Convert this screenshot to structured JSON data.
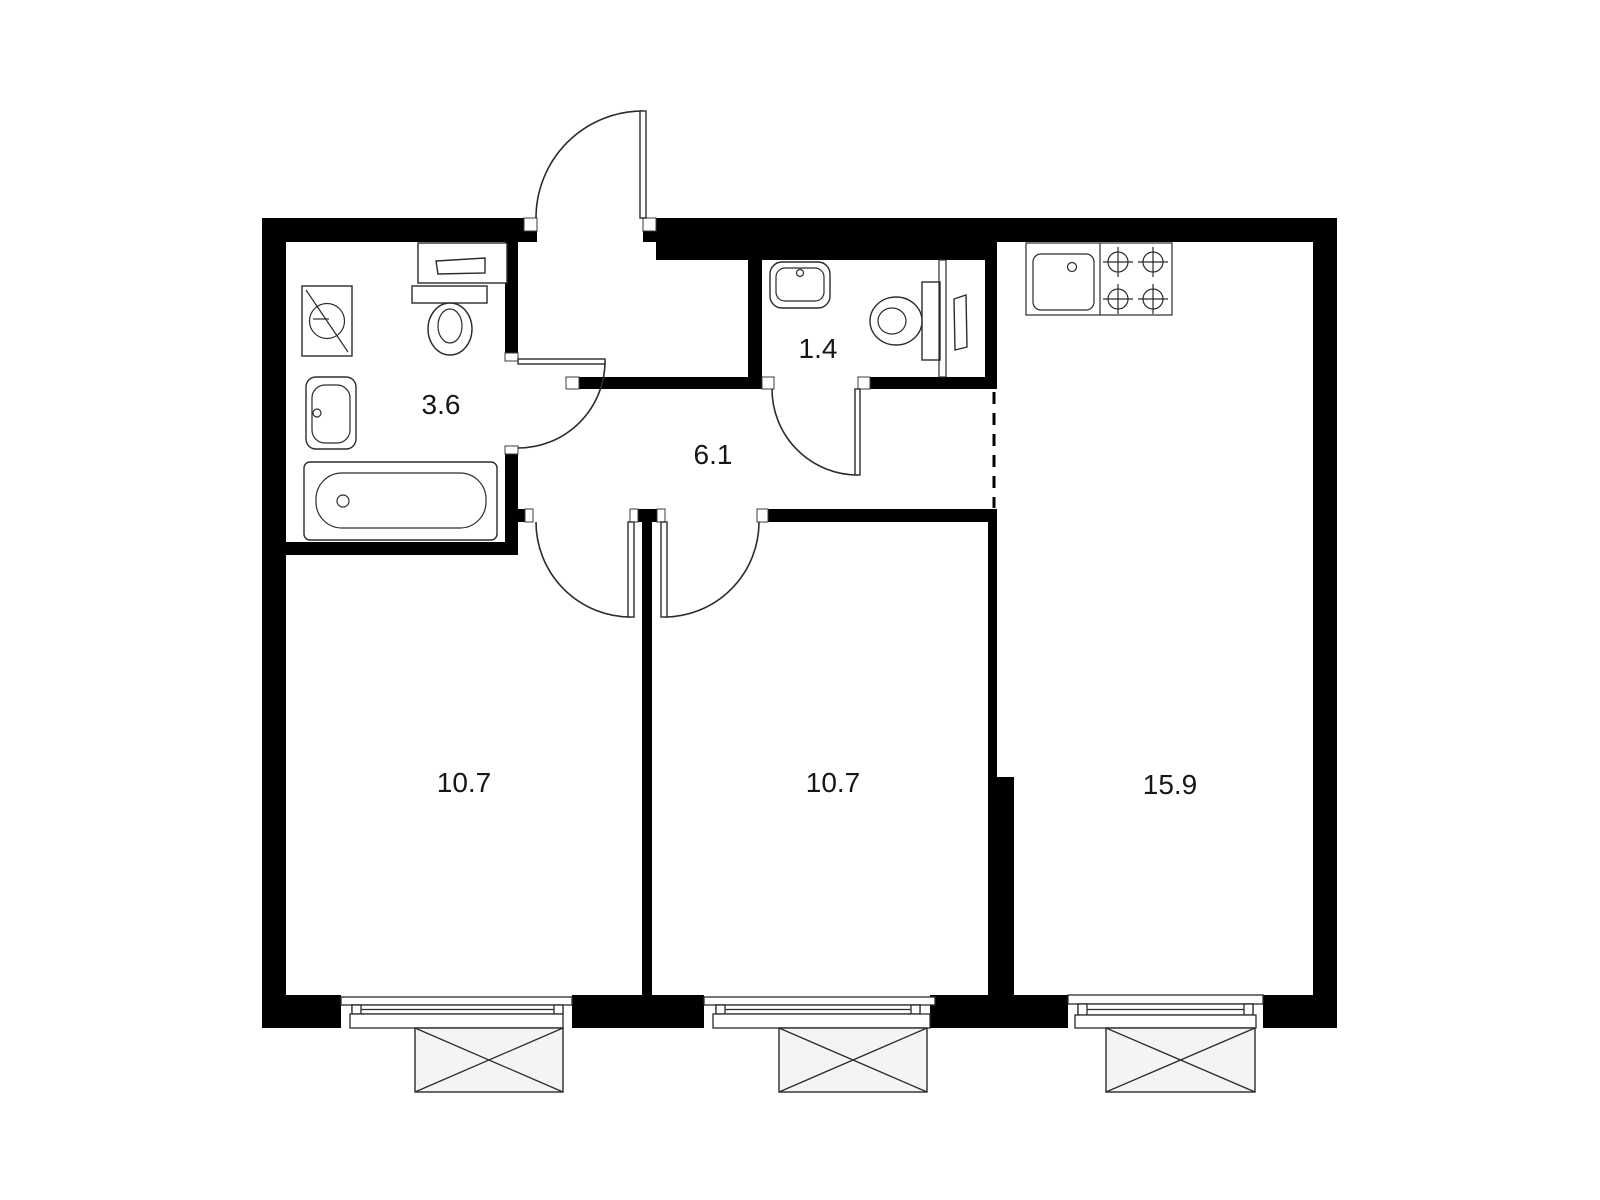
{
  "floor_plan": {
    "type": "apartment-floor-plan",
    "rooms": [
      {
        "id": "bathroom",
        "area_label": "3.6"
      },
      {
        "id": "wc",
        "area_label": "1.4"
      },
      {
        "id": "hallway",
        "area_label": "6.1"
      },
      {
        "id": "room-left",
        "area_label": "10.7"
      },
      {
        "id": "room-middle",
        "area_label": "10.7"
      },
      {
        "id": "kitchen-living-room",
        "area_label": "15.9"
      }
    ],
    "fixtures": [
      "washing-machine",
      "water-heater-shelf",
      "toilet",
      "wash-basin",
      "bathtub",
      "wc-sink",
      "wc-toilet",
      "kitchen-sink",
      "stove-4-burners"
    ],
    "features": [
      "entrance-door",
      "bathroom-door",
      "wc-door",
      "room-left-door",
      "room-middle-door",
      "window",
      "window",
      "window",
      "open-boundary-dashed"
    ],
    "colors": {
      "wall": "#000000",
      "line": "#2b2b2b",
      "label": "#161616",
      "background": "#ffffff",
      "box_fill": "#f4f4f4"
    }
  }
}
